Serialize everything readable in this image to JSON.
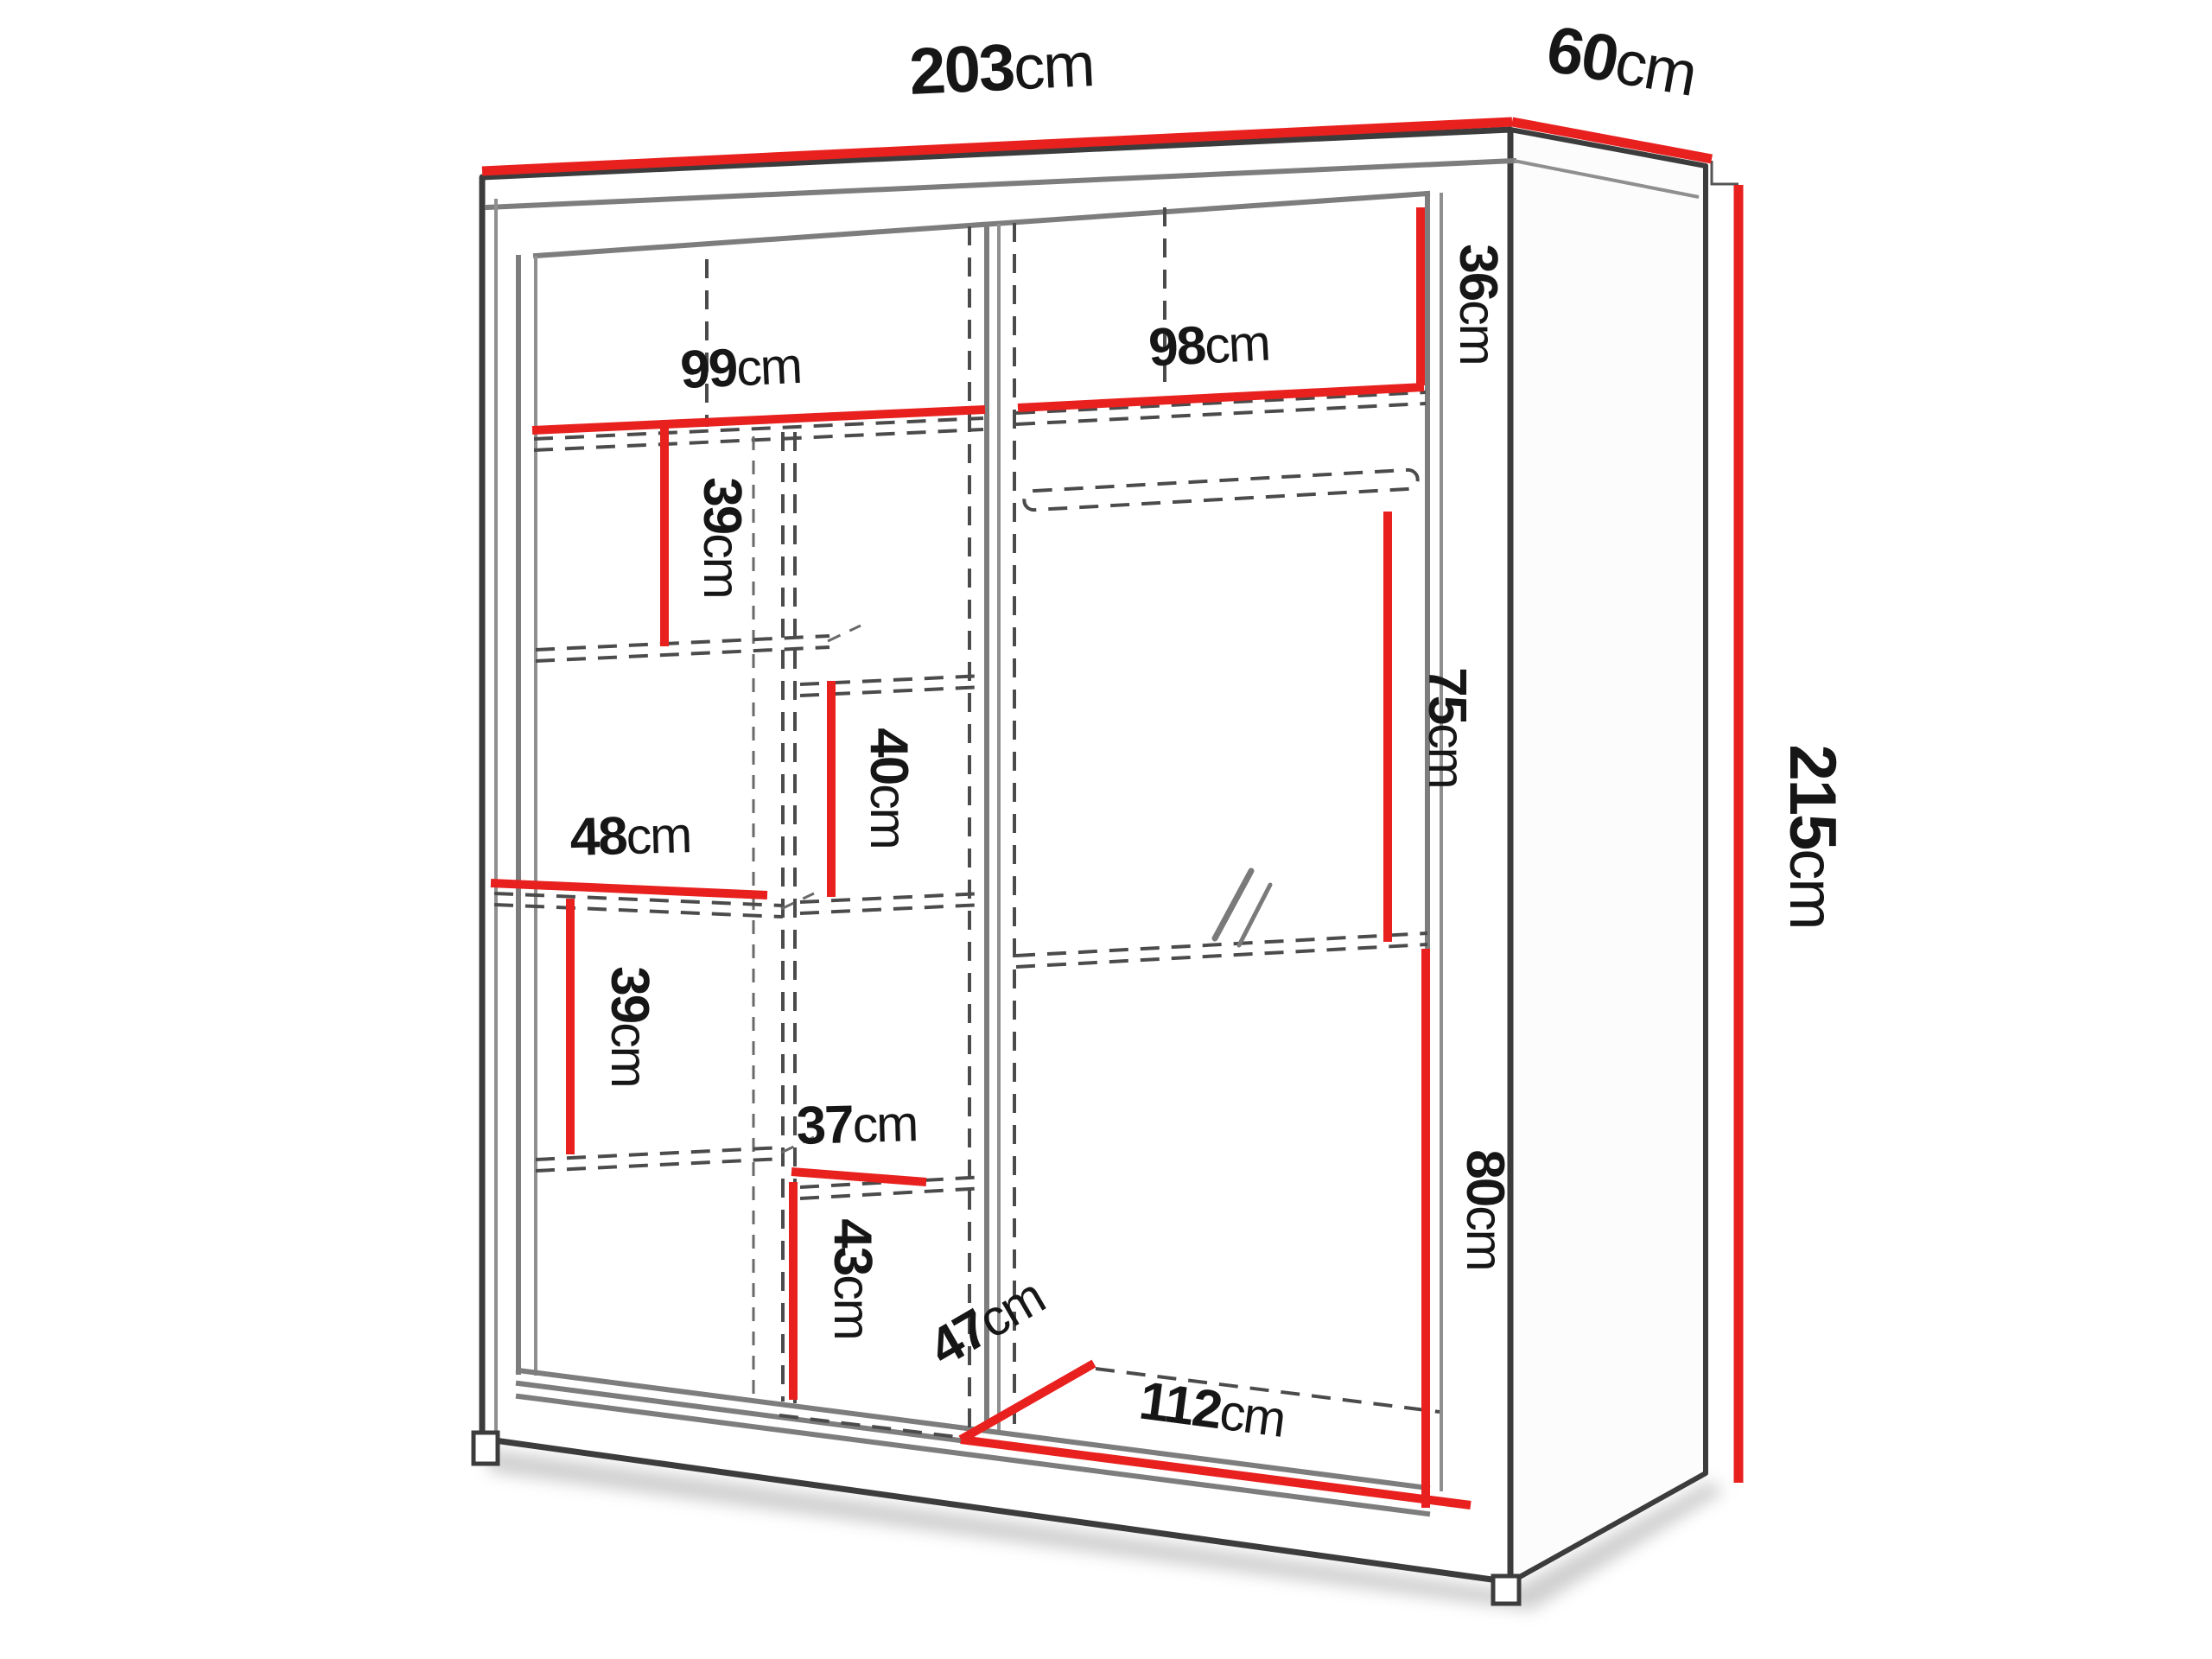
{
  "diagram": {
    "title": "wardrobe-dimension-diagram",
    "unit": "cm",
    "colors": {
      "dimension_red": "#e8211f",
      "outline_dark": "#3c3c3c",
      "outline_gray": "#7d7d7d",
      "dashed_gray": "#4b4b4b"
    },
    "dims": {
      "overall_width": {
        "value": "203",
        "unit": "cm"
      },
      "overall_depth": {
        "value": "60",
        "unit": "cm"
      },
      "overall_height": {
        "value": "215",
        "unit": "cm"
      },
      "left_top_shelf_width": {
        "value": "99",
        "unit": "cm"
      },
      "right_top_shelf_width": {
        "value": "98",
        "unit": "cm"
      },
      "top_right_cubby_height": {
        "value": "36",
        "unit": "cm"
      },
      "left_upper_cubby_height": {
        "value": "39",
        "unit": "cm"
      },
      "center_cubby_height": {
        "value": "40",
        "unit": "cm"
      },
      "left_shelf_width": {
        "value": "48",
        "unit": "cm"
      },
      "left_lower_cubby_height": {
        "value": "39",
        "unit": "cm"
      },
      "center_shelf_width": {
        "value": "37",
        "unit": "cm"
      },
      "center_bottom_cubby_height": {
        "value": "43",
        "unit": "cm"
      },
      "hanging_space_height": {
        "value": "75",
        "unit": "cm"
      },
      "right_lower_section_height": {
        "value": "80",
        "unit": "cm"
      },
      "bottom_compartment_depth": {
        "value": "47",
        "unit": "cm"
      },
      "bottom_compartment_width": {
        "value": "112",
        "unit": "cm"
      }
    }
  }
}
